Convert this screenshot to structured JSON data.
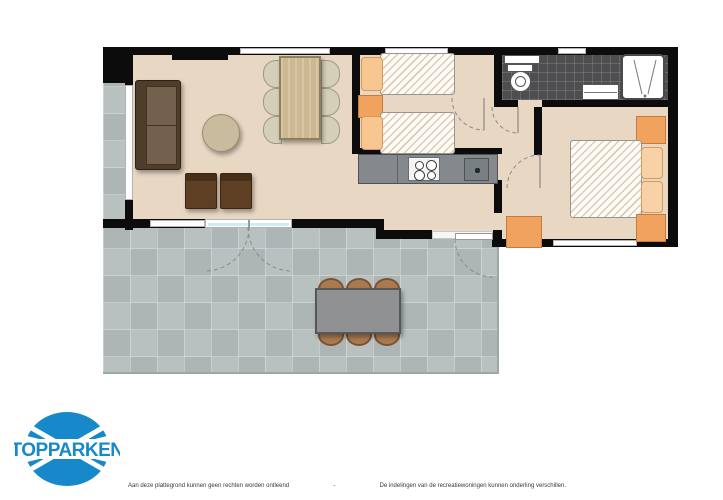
{
  "brand": {
    "logo_text": "TOPPARKEN",
    "logo_color": "#1789ca"
  },
  "footer": {
    "disclaimer_left": "Aan deze plattegrond kunnen geen rechten worden ontleend",
    "separator": "-",
    "disclaimer_right": "De indelingen van de recreatiewoningen kunnen onderling verschillen."
  },
  "floorplan": {
    "type": "holiday-home-floor-plan",
    "rooms": [
      {
        "name": "living-room",
        "furniture": [
          "sofa",
          "coffee-table",
          "armchair",
          "armchair",
          "dining-table",
          "dining-chairs-6",
          "tv"
        ]
      },
      {
        "name": "kitchen",
        "furniture": [
          "counter",
          "cooktop-4-burners",
          "sink"
        ]
      },
      {
        "name": "bedroom-twin",
        "furniture": [
          "single-bed",
          "single-bed",
          "nightstand"
        ]
      },
      {
        "name": "bathroom",
        "furniture": [
          "toilet",
          "washbasin",
          "shower",
          "shelf"
        ]
      },
      {
        "name": "bedroom-double",
        "furniture": [
          "double-bed",
          "nightstand",
          "nightstand",
          "wardrobe"
        ]
      },
      {
        "name": "hallway",
        "furniture": [
          "cabinet"
        ]
      },
      {
        "name": "terrace",
        "furniture": [
          "garden-table",
          "garden-chairs-6"
        ]
      }
    ],
    "colors": {
      "wall": "#0c0c0c",
      "floor": "#e8d7c3",
      "terrace_tile": "#b4bbbb",
      "bathroom_tile": "#4e4e51",
      "accent_orange": "#f1a25e",
      "wood": "#cdb991",
      "sofa_brown": "#4f3d2c",
      "glass_door": "#cdeef6"
    }
  }
}
